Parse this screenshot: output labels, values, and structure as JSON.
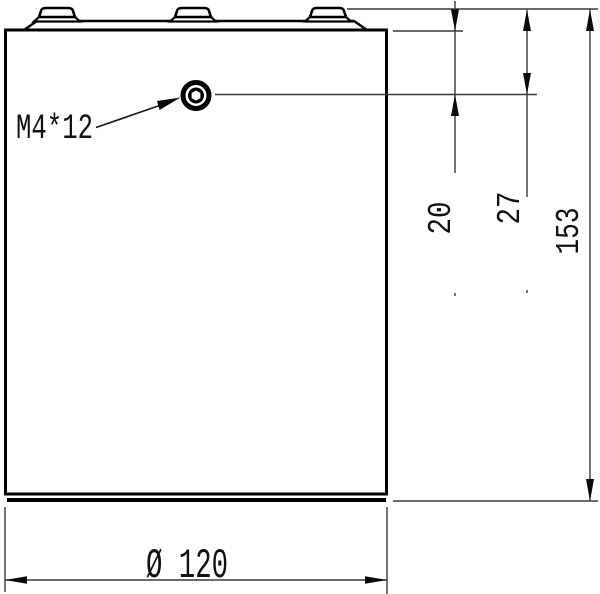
{
  "drawing": {
    "thread_callout": "M4*12",
    "dim_body_top_to_hole": "20",
    "dim_terminal_top_to_hole": "27",
    "dim_overall_height": "153",
    "dim_diameter": "Ø 120"
  }
}
